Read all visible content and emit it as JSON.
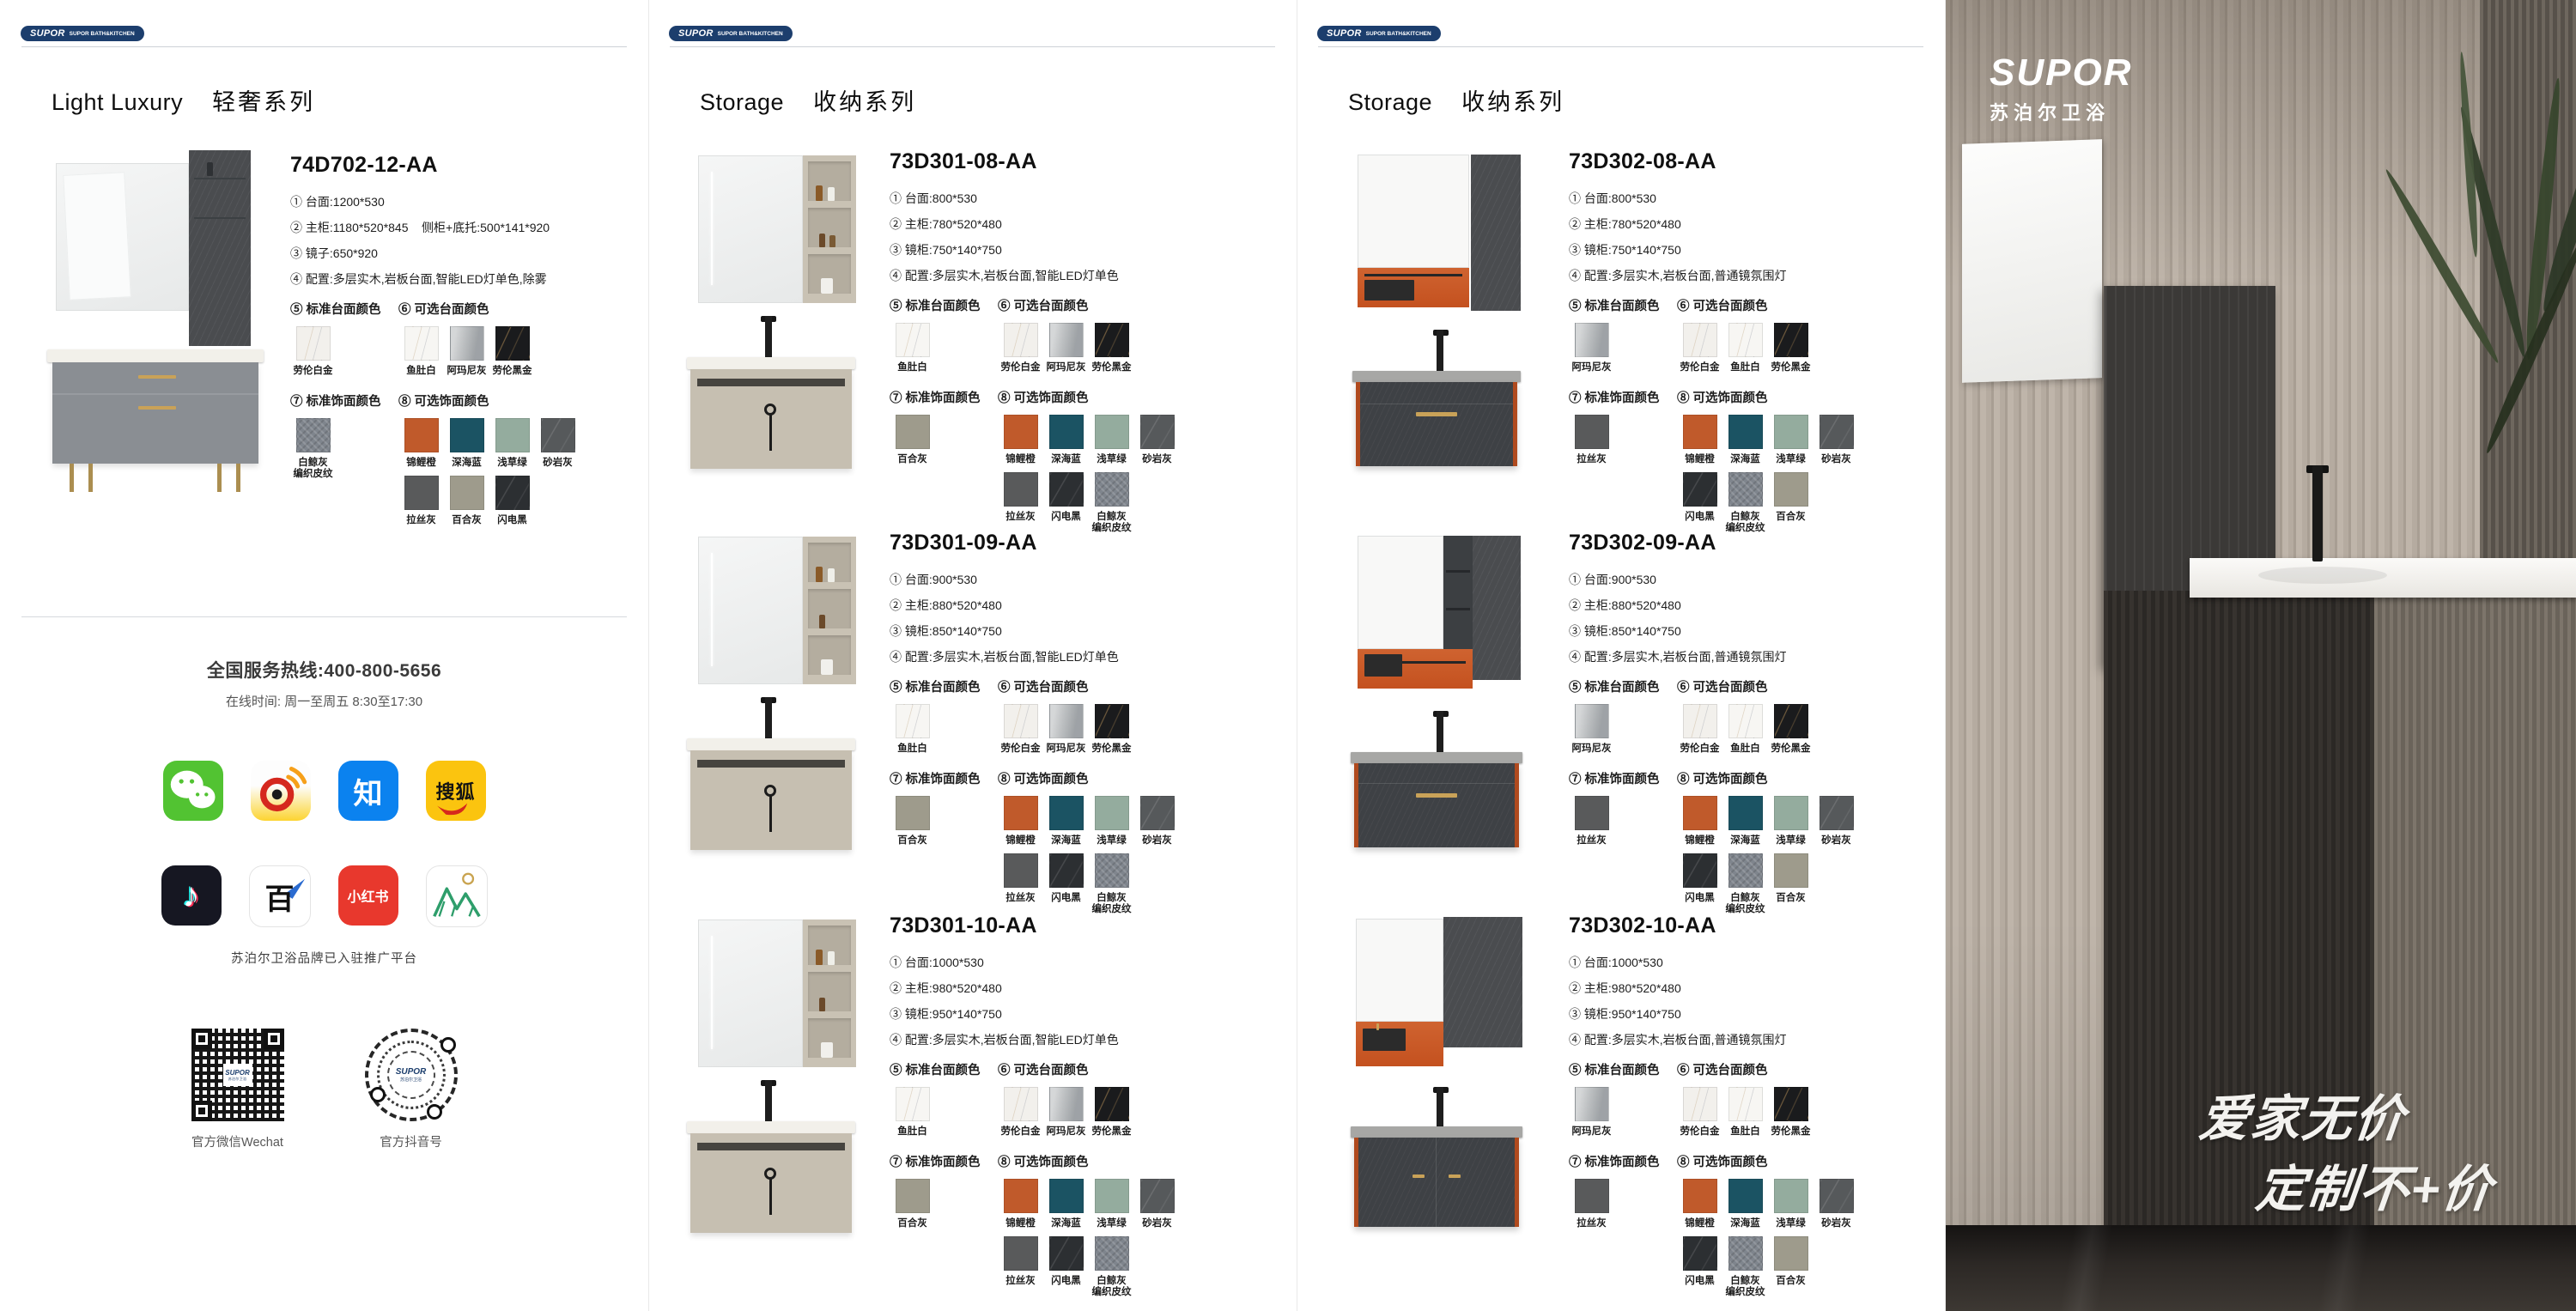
{
  "brand": {
    "name": "SUPOR",
    "tagline": "SUPOR BATH&KITCHEN",
    "navy": "#1c3e6d"
  },
  "labels": {
    "ct_std": "⑤ 标准台面颜色",
    "ct_opt": "⑥ 可选台面颜色",
    "fin_std": "⑦ 标准饰面颜色",
    "fin_opt": "⑧ 可选饰面颜色"
  },
  "panels": [
    {
      "series_en": "Light Luxury",
      "series_cn": "轻奢系列",
      "products": [
        {
          "code": "74D702-12-AA",
          "specs": [
            "① 台面:1200*530",
            "② 主柜:1180*520*845    侧柜+底托:500*141*920",
            "③ 镜子:650*920",
            "④ 配置:多层实木,岩板台面,智能LED灯单色,除雾"
          ]
        }
      ],
      "swatches": {
        "ct_std": [
          {
            "name": "劳伦白金",
            "color": "#f2f0ec",
            "texture": "marble-light"
          }
        ],
        "ct_opt": [
          {
            "name": "鱼肚白",
            "color": "#f7f6f3",
            "texture": "marble-light"
          },
          {
            "name": "阿玛尼灰",
            "color": "#b9bcbe",
            "texture": "marble-grey"
          },
          {
            "name": "劳伦黑金",
            "color": "#1a1b1d",
            "texture": "marble-dark"
          }
        ],
        "fin_std": [
          {
            "name": "白鲸灰\n编织皮纹",
            "color": "#7f858d",
            "texture": "weave"
          }
        ],
        "fin_opt": [
          {
            "name": "锦鲤橙",
            "color": "#c05a2b",
            "texture": "plain"
          },
          {
            "name": "深海蓝",
            "color": "#1b5363",
            "texture": "plain"
          },
          {
            "name": "浅草绿",
            "color": "#94ac9e",
            "texture": "plain"
          },
          {
            "name": "砂岩灰",
            "color": "#56595b",
            "texture": "stone"
          },
          {
            "name": "拉丝灰",
            "color": "#595a5b",
            "texture": "plain"
          },
          {
            "name": "百合灰",
            "color": "#9e9b8c",
            "texture": "plain"
          },
          {
            "name": "闪电黑",
            "color": "#2c2f32",
            "texture": "stone"
          }
        ]
      }
    },
    {
      "series_en": "Storage",
      "series_cn": "收纳系列",
      "products": [
        {
          "code": "73D301-08-AA",
          "specs": [
            "① 台面:800*530",
            "② 主柜:780*520*480",
            "③ 镜柜:750*140*750",
            "④ 配置:多层实木,岩板台面,智能LED灯单色"
          ]
        },
        {
          "code": "73D301-09-AA",
          "specs": [
            "① 台面:900*530",
            "② 主柜:880*520*480",
            "③ 镜柜:850*140*750",
            "④ 配置:多层实木,岩板台面,智能LED灯单色"
          ]
        },
        {
          "code": "73D301-10-AA",
          "specs": [
            "① 台面:1000*530",
            "② 主柜:980*520*480",
            "③ 镜柜:950*140*750",
            "④ 配置:多层实木,岩板台面,智能LED灯单色"
          ]
        }
      ],
      "swatches": {
        "ct_std": [
          {
            "name": "鱼肚白",
            "color": "#f7f6f3",
            "texture": "marble-light"
          }
        ],
        "ct_opt": [
          {
            "name": "劳伦白金",
            "color": "#f2f0ec",
            "texture": "marble-light"
          },
          {
            "name": "阿玛尼灰",
            "color": "#b9bcbe",
            "texture": "marble-grey"
          },
          {
            "name": "劳伦黑金",
            "color": "#1a1b1d",
            "texture": "marble-dark"
          }
        ],
        "fin_std": [
          {
            "name": "百合灰",
            "color": "#9e9b8c",
            "texture": "plain"
          }
        ],
        "fin_opt": [
          {
            "name": "锦鲤橙",
            "color": "#c05a2b",
            "texture": "plain"
          },
          {
            "name": "深海蓝",
            "color": "#1b5363",
            "texture": "plain"
          },
          {
            "name": "浅草绿",
            "color": "#94ac9e",
            "texture": "plain"
          },
          {
            "name": "砂岩灰",
            "color": "#56595b",
            "texture": "stone"
          },
          {
            "name": "拉丝灰",
            "color": "#595a5b",
            "texture": "plain"
          },
          {
            "name": "闪电黑",
            "color": "#2c2f32",
            "texture": "stone"
          },
          {
            "name": "白鲸灰\n编织皮纹",
            "color": "#7f858d",
            "texture": "weave"
          }
        ]
      }
    },
    {
      "series_en": "Storage",
      "series_cn": "收纳系列",
      "products": [
        {
          "code": "73D302-08-AA",
          "specs": [
            "① 台面:800*530",
            "② 主柜:780*520*480",
            "③ 镜柜:750*140*750",
            "④ 配置:多层实木,岩板台面,普通镜氛围灯"
          ]
        },
        {
          "code": "73D302-09-AA",
          "specs": [
            "① 台面:900*530",
            "② 主柜:880*520*480",
            "③ 镜柜:850*140*750",
            "④ 配置:多层实木,岩板台面,普通镜氛围灯"
          ]
        },
        {
          "code": "73D302-10-AA",
          "specs": [
            "① 台面:1000*530",
            "② 主柜:980*520*480",
            "③ 镜柜:950*140*750",
            "④ 配置:多层实木,岩板台面,普通镜氛围灯"
          ]
        }
      ],
      "swatches": {
        "ct_std": [
          {
            "name": "阿玛尼灰",
            "color": "#b9bcbe",
            "texture": "marble-grey"
          }
        ],
        "ct_opt": [
          {
            "name": "劳伦白金",
            "color": "#f2f0ec",
            "texture": "marble-light"
          },
          {
            "name": "鱼肚白",
            "color": "#f7f6f3",
            "texture": "marble-light"
          },
          {
            "name": "劳伦黑金",
            "color": "#1a1b1d",
            "texture": "marble-dark"
          }
        ],
        "fin_std": [
          {
            "name": "拉丝灰",
            "color": "#595a5b",
            "texture": "plain"
          }
        ],
        "fin_opt": [
          {
            "name": "锦鲤橙",
            "color": "#c05a2b",
            "texture": "plain"
          },
          {
            "name": "深海蓝",
            "color": "#1b5363",
            "texture": "plain"
          },
          {
            "name": "浅草绿",
            "color": "#94ac9e",
            "texture": "plain"
          },
          {
            "name": "砂岩灰",
            "color": "#56595b",
            "texture": "stone"
          },
          {
            "name": "闪电黑",
            "color": "#2c2f32",
            "texture": "stone"
          },
          {
            "name": "白鲸灰\n编织皮纹",
            "color": "#7f858d",
            "texture": "weave"
          },
          {
            "name": "百合灰",
            "color": "#9e9b8c",
            "texture": "plain"
          }
        ]
      }
    }
  ],
  "service": {
    "hotline": "全国服务热线:400-800-5656",
    "hours": "在线时间: 周一至周五  8:30至17:30",
    "note": "苏泊尔卫浴品牌已入驻推广平台",
    "qr_wechat_label": "官方微信Wechat",
    "qr_douyin_label": "官方抖音号",
    "qr_brand": "SUPOR",
    "qr_brand_sub": "苏泊尔卫浴",
    "glyphs": {
      "zhihu": "知",
      "sohu": "搜狐",
      "douyin": "♪",
      "baijiahao": "百",
      "xiaohongshu": "小红书"
    }
  },
  "photo": {
    "logo": "SUPOR",
    "logo_sub": "苏泊尔卫浴",
    "slogan1": "爱家无价",
    "slogan2": "定制不+价",
    "cabinet_logo": "SUPOR",
    "cabinet_logo_sub": "苏泊尔卫浴"
  }
}
